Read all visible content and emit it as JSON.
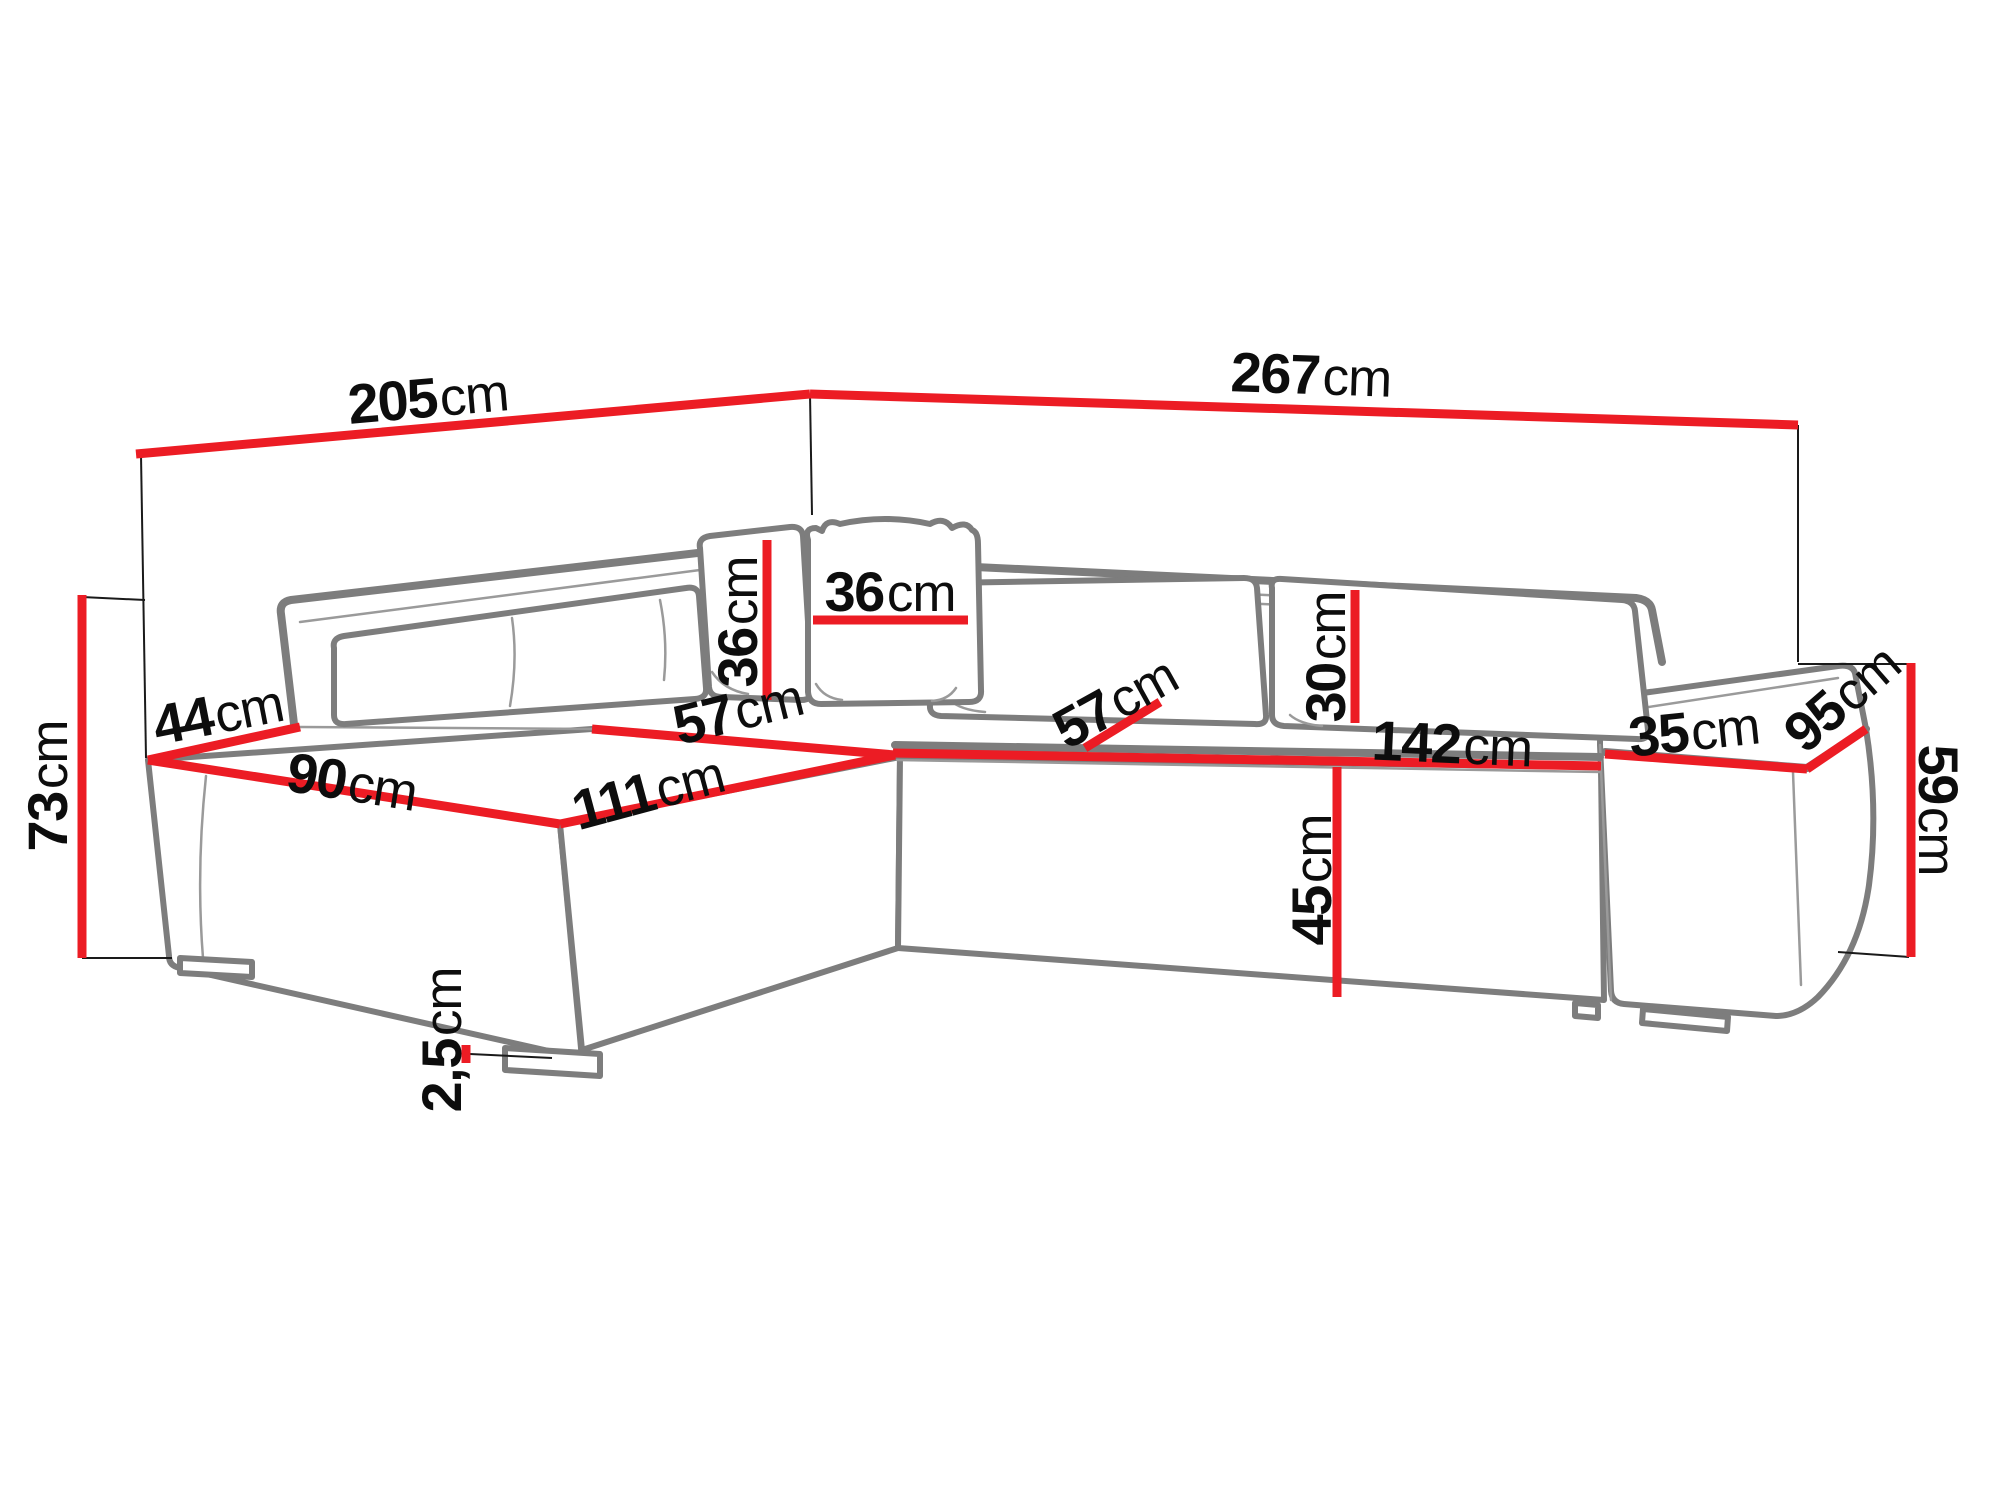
{
  "diagram": {
    "type": "furniture dimension diagram",
    "subject": "corner sofa with chaise, cushions, pillows and armrest pouf",
    "unit": "cm"
  },
  "colors": {
    "bg": "#ffffff",
    "dimline": "#ec1c24",
    "outline": "#7d7d7d",
    "outline-light": "#9a9a9a",
    "thinline": "#1a1a1a",
    "text": "#0d0d0d"
  },
  "dimensions": [
    {
      "id": "back-width-left",
      "value": "205",
      "unit": "cm"
    },
    {
      "id": "back-width-right",
      "value": "267",
      "unit": "cm"
    },
    {
      "id": "total-height",
      "value": "73",
      "unit": "cm"
    },
    {
      "id": "side-ledge-depth",
      "value": "44",
      "unit": "cm"
    },
    {
      "id": "chaise-front-width",
      "value": "90",
      "unit": "cm"
    },
    {
      "id": "chaise-side-length",
      "value": "111",
      "unit": "cm"
    },
    {
      "id": "corner-seat-width",
      "value": "57",
      "unit": "cm"
    },
    {
      "id": "pillow-left-height",
      "value": "36",
      "unit": "cm"
    },
    {
      "id": "pillow-right-width",
      "value": "36",
      "unit": "cm"
    },
    {
      "id": "seat-depth-right",
      "value": "57",
      "unit": "cm"
    },
    {
      "id": "backrest-cushion-height",
      "value": "30",
      "unit": "cm"
    },
    {
      "id": "seat-front-width",
      "value": "142",
      "unit": "cm"
    },
    {
      "id": "armrest-width",
      "value": "35",
      "unit": "cm"
    },
    {
      "id": "armrest-depth",
      "value": "95",
      "unit": "cm"
    },
    {
      "id": "armrest-height",
      "value": "59",
      "unit": "cm"
    },
    {
      "id": "seat-height",
      "value": "45",
      "unit": "cm"
    },
    {
      "id": "foot-height",
      "value": "2,5",
      "unit": "cm"
    }
  ]
}
